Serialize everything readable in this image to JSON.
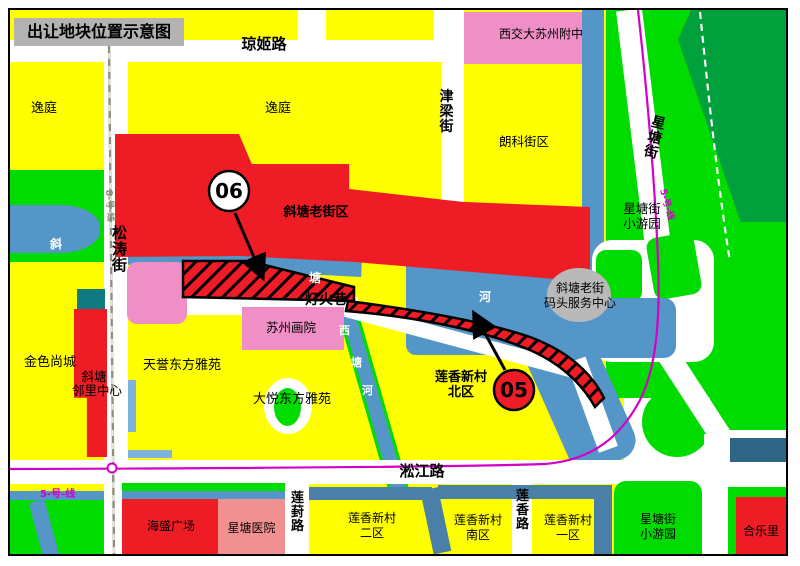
{
  "title": "出让地块位置示意图",
  "roads": {
    "qiongji": "琼姬路",
    "jinliang": "津梁街",
    "songtao": "松涛街",
    "xingtang": "星塘街",
    "denghuoxiang": "灯火巷",
    "songjiang": "淞江路",
    "lianfeng": "莲葑路",
    "lianxiang": "莲香路"
  },
  "rivers": {
    "xietang": [
      "斜",
      "塘",
      "河"
    ],
    "xitang": [
      "西",
      "塘",
      "河"
    ]
  },
  "transit": {
    "line5": "5-号-线",
    "line8": "8-号-线"
  },
  "plots": {
    "p06": "06",
    "p05": "05"
  },
  "areas": {
    "yiting_west": "逸庭",
    "yiting_east": "逸庭",
    "school": "西交大苏州附中",
    "langke": "朗科街区",
    "old_street": "斜塘老街区",
    "wharf": [
      "斜塘老街",
      "码头服务中心"
    ],
    "xingtang_park_north": [
      "星塘街",
      "小游园"
    ],
    "jinse": "金色尚城",
    "neighborhood_center": [
      "斜塘",
      "邻里中心"
    ],
    "tianyu": "天誉东方雅苑",
    "dayue": "大悦东方雅苑",
    "academy": "苏州画院",
    "lianxiang_north": [
      "莲香新村",
      "北区"
    ],
    "haisheng": "海盛广场",
    "hospital": "星塘医院",
    "lianxiang_2": [
      "莲香新村",
      "二区"
    ],
    "lianxiang_south": [
      "莲香新村",
      "南区"
    ],
    "lianxiang_1": [
      "莲香新村",
      "一区"
    ],
    "xingtang_park_south": [
      "星塘街",
      "小游园"
    ],
    "heleli": "合乐里"
  },
  "colors": {
    "plot_red": "#ee1c24",
    "water_blue": "#5596c8",
    "park_green": "#00dc00",
    "dark_green": "#00a03c",
    "block_yellow": "#ffff00",
    "metro_line5": "#d400c8",
    "metro_line8": "#8f8f80",
    "school_pink": "#ef8fc6",
    "hospital_pink": "#f09090",
    "teal_block": "#0f7a80",
    "slate_block": "#2f6585",
    "title_bg": "#b3b3b3"
  }
}
